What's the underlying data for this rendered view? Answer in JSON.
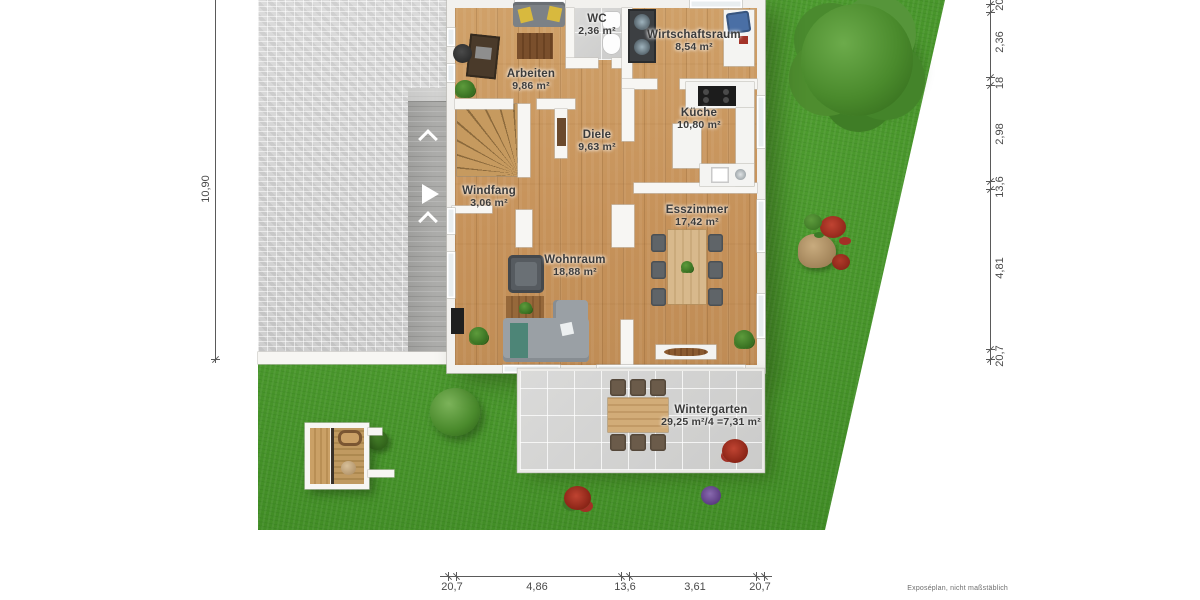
{
  "rooms": {
    "arbeiten": {
      "name": "Arbeiten",
      "area": "9,86 m²"
    },
    "wc": {
      "name": "WC",
      "area": "2,36 m²"
    },
    "wirtschaftsraum": {
      "name": "Wirtschaftsraum",
      "area": "8,54 m²"
    },
    "kueche": {
      "name": "Küche",
      "area": "10,80 m²"
    },
    "diele": {
      "name": "Diele",
      "area": "9,63 m²"
    },
    "windfang": {
      "name": "Windfang",
      "area": "3,06 m²"
    },
    "wohnraum": {
      "name": "Wohnraum",
      "area": "18,88 m²"
    },
    "esszimmer": {
      "name": "Esszimmer",
      "area": "17,42 m²"
    },
    "wintergarten": {
      "name": "Wintergarten",
      "area": "29,25 m²/4 =7,31 m²"
    }
  },
  "dimensions": {
    "left_total": "10,90",
    "right": [
      "20,7",
      "2,36",
      "18",
      "2,98",
      "13,6",
      "4,81",
      "20,7"
    ],
    "bottom": [
      "20,7",
      "4,86",
      "13,6",
      "3,61",
      "20,7"
    ]
  },
  "footer": {
    "note": "Exposéplan, nicht maßstäblich"
  },
  "colors": {
    "lawn": "#4c9a2e",
    "paving": "#d8d8d8",
    "wood_floor": "#c9965c",
    "tile": "#d4d4d3",
    "wall": "#f7f6f3",
    "dimension_text": "#4a4a4a"
  }
}
